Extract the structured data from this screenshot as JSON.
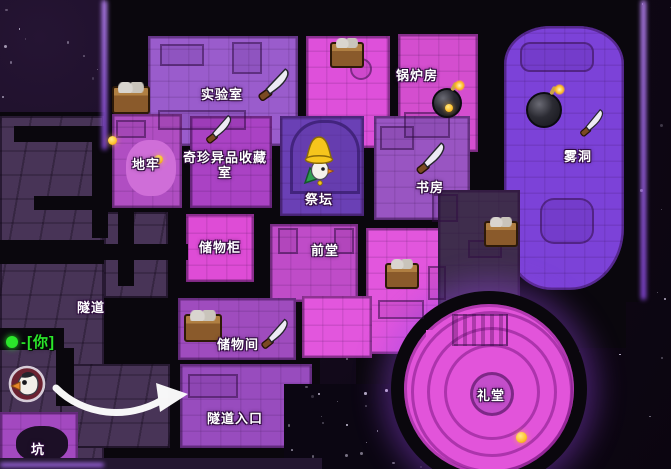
{
  "map": {
    "rooms": [
      {
        "id": "laboratory",
        "label": "实验室"
      },
      {
        "id": "boiler-room",
        "label": "锅炉房"
      },
      {
        "id": "fog-cave",
        "label": "雾洞"
      },
      {
        "id": "dungeon",
        "label": "地牢"
      },
      {
        "id": "curiosities-collection-room",
        "label": "奇珍异品收藏室"
      },
      {
        "id": "altar",
        "label": "祭坛"
      },
      {
        "id": "study",
        "label": "书房"
      },
      {
        "id": "lockers",
        "label": "储物柜"
      },
      {
        "id": "front-hall",
        "label": "前堂"
      },
      {
        "id": "tunnel",
        "label": "隧道"
      },
      {
        "id": "storage-room",
        "label": "储物间"
      },
      {
        "id": "tunnel-entrance",
        "label": "隧道入口"
      },
      {
        "id": "auditorium",
        "label": "礼堂"
      },
      {
        "id": "pit",
        "label": "坑"
      }
    ],
    "player_marker": {
      "dash": "-",
      "label": "[你]",
      "color": "#2be52b"
    },
    "items": [
      {
        "type": "crate",
        "location": "laboratory-west"
      },
      {
        "type": "knife",
        "location": "laboratory"
      },
      {
        "type": "crate",
        "location": "kitchen-nook"
      },
      {
        "type": "bomb",
        "location": "boiler-room"
      },
      {
        "type": "bomb",
        "location": "fog-cave"
      },
      {
        "type": "knife",
        "location": "fog-cave"
      },
      {
        "type": "knife",
        "location": "curiosities-collection-room"
      },
      {
        "type": "knife",
        "location": "study"
      },
      {
        "type": "crate",
        "location": "east-corridor"
      },
      {
        "type": "crate",
        "location": "dining-hall"
      },
      {
        "type": "crate",
        "location": "storage-room"
      },
      {
        "type": "knife",
        "location": "storage-room"
      },
      {
        "type": "coin",
        "location": "dungeon"
      },
      {
        "type": "coin",
        "location": "dungeon"
      },
      {
        "type": "coin",
        "location": "auditorium"
      },
      {
        "type": "coin",
        "location": "boiler-room"
      }
    ],
    "character": {
      "id": "altar-character",
      "description": "yellow-hat goose standing in altar"
    },
    "icons": {
      "knife": "knife-icon",
      "bomb": "bomb-icon",
      "crate": "crate-icon",
      "coin": "coin-sparkle-icon",
      "player": "player-avatar",
      "arrow": "guide-arrow-icon"
    }
  },
  "colors": {
    "space_background": "#130a1d",
    "wall_black": "#0a070d",
    "room_purple": "#9a5ccc",
    "room_magenta": "#e052d8",
    "room_violet": "#7c42d8",
    "maze_purple": "#483457",
    "label_text": "#ffffff",
    "marker_green": "#2be52b",
    "edge_glow": "#b36dff"
  }
}
